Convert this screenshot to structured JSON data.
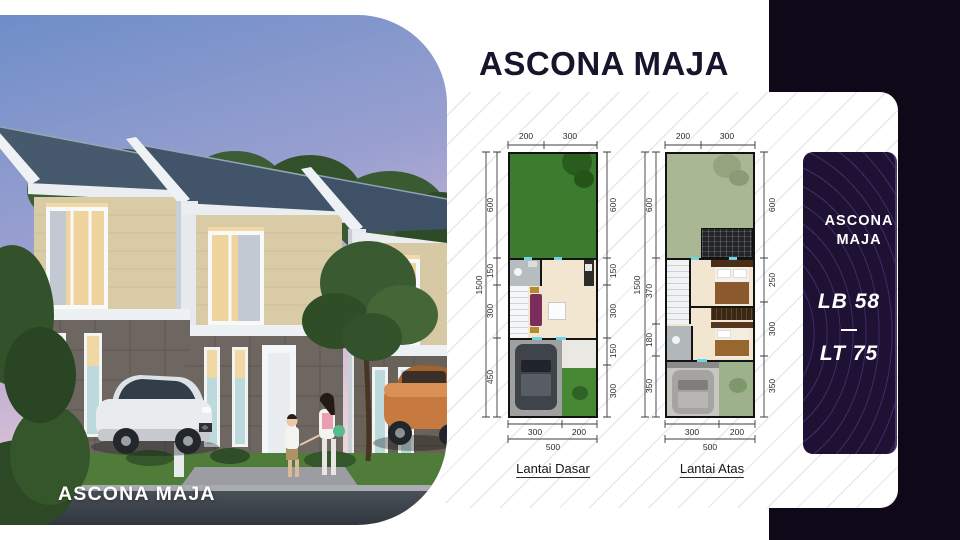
{
  "header": {
    "title": "ASCONA MAJA"
  },
  "photo": {
    "caption": "ASCONA MAJA"
  },
  "floor_plans": [
    {
      "label": "Lantai Dasar",
      "overall_height": "1500",
      "overall_width": "500",
      "top_dims": [
        "200",
        "300"
      ],
      "left_dims": [
        "600",
        "150",
        "300",
        "450"
      ],
      "right_dims": [
        "600",
        "150",
        "300",
        "150",
        "300"
      ],
      "bottom_dims": [
        "300",
        "200"
      ]
    },
    {
      "label": "Lantai Atas",
      "overall_height": "1500",
      "overall_width": "500",
      "top_dims": [
        "200",
        "300"
      ],
      "left_dims": [
        "600",
        "370",
        "180",
        "350"
      ],
      "right_dims": [
        "600",
        "250",
        "300",
        "350"
      ],
      "bottom_dims": [
        "300",
        "200"
      ]
    }
  ],
  "info_card": {
    "title": "ASCONA MAJA",
    "building_area": "LB 58",
    "land_area": "LT 75"
  },
  "colors": {
    "dark_background": "#0f0819",
    "card_background": "#1e1133",
    "title_text": "#15152b",
    "garden_green": "#3c7c2e",
    "sky_dusk_top": "#6e8ec8",
    "sky_dusk_bottom": "#e9d4da"
  }
}
